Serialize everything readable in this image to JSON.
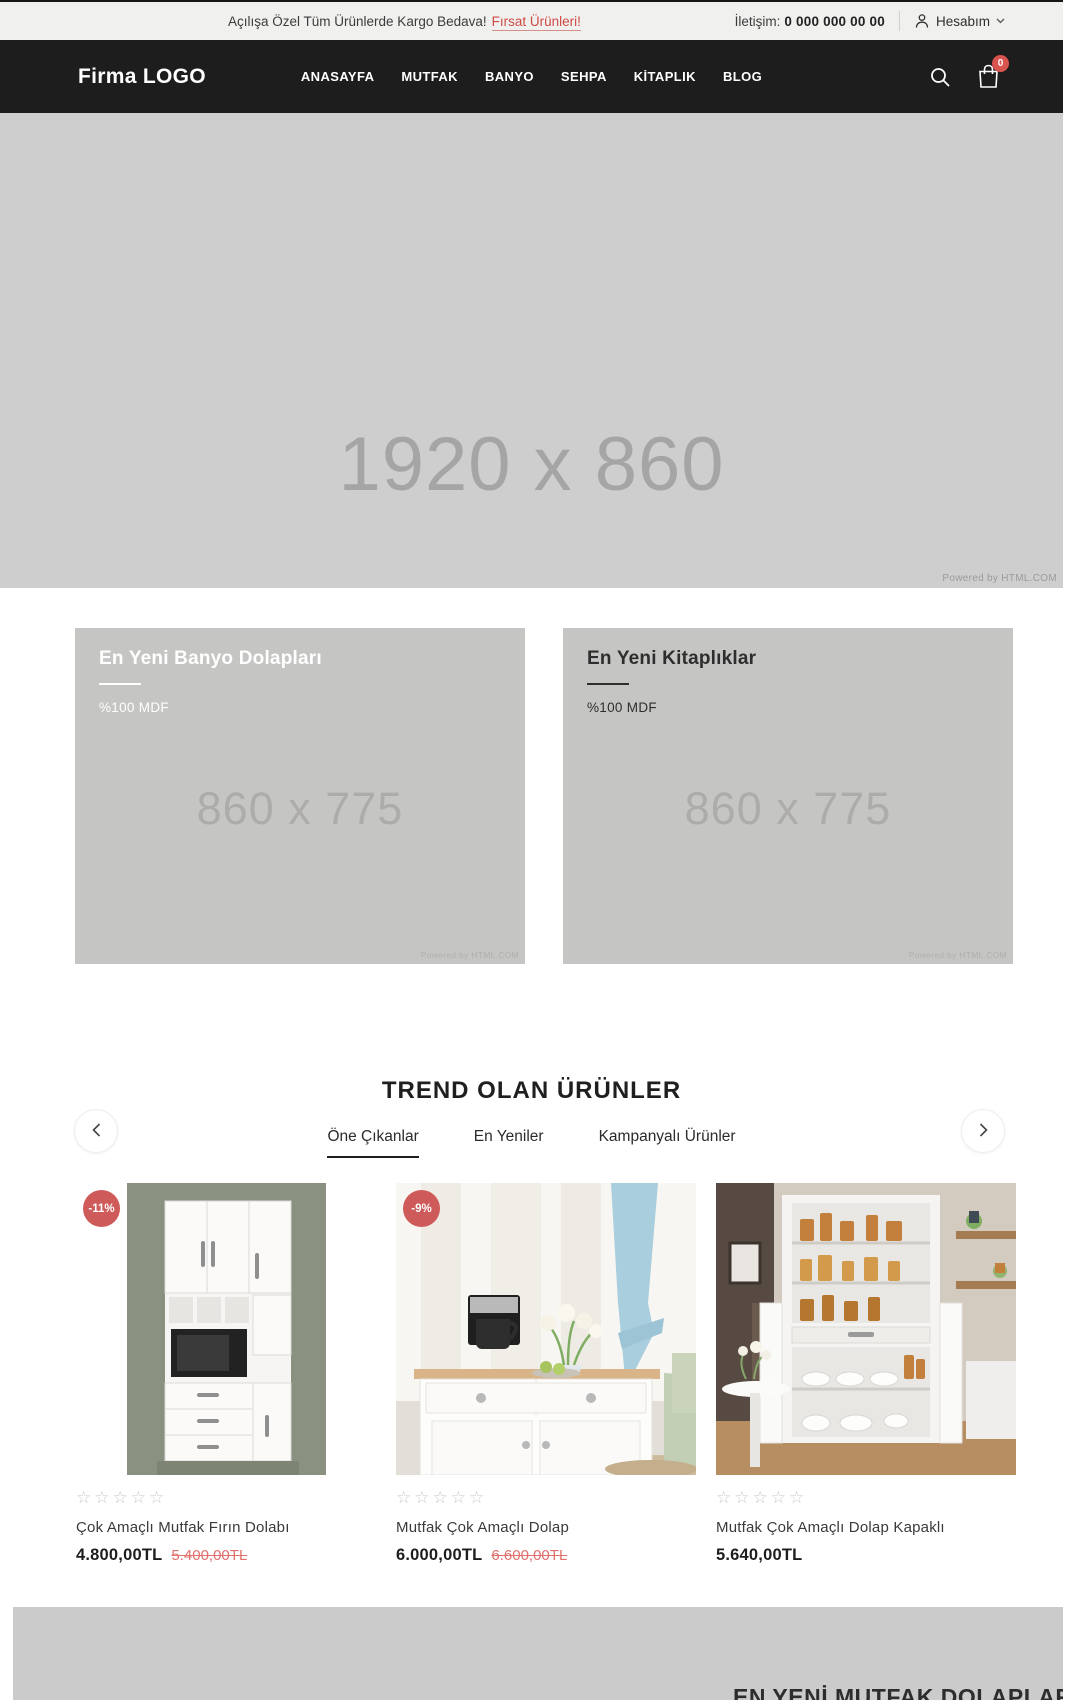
{
  "topbar": {
    "promo_text": "Açılışa Özel Tüm Ürünlerde Kargo Bedava!",
    "promo_link": "Fırsat Ürünleri!",
    "contact_label": "İletişim:",
    "contact_phone": "0 000 000 00 00",
    "account_label": "Hesabım"
  },
  "header": {
    "logo": "Firma LOGO",
    "nav": [
      "ANASAYFA",
      "MUTFAK",
      "BANYO",
      "SEHPA",
      "KİTAPLIK",
      "BLOG"
    ],
    "cart_count": "0"
  },
  "hero": {
    "placeholder": "1920 x 860",
    "watermark": "Powered by HTML.COM"
  },
  "banners": [
    {
      "title": "En Yeni Banyo Dolapları",
      "subtitle": "%100 MDF",
      "placeholder": "860 x 775",
      "watermark": "Powered by HTML.COM"
    },
    {
      "title": "En Yeni Kitaplıklar",
      "subtitle": "%100 MDF",
      "placeholder": "860 x 775",
      "watermark": "Powered by HTML.COM"
    }
  ],
  "trending": {
    "title": "TREND OLAN ÜRÜNLER",
    "tabs": [
      "Öne Çıkanlar",
      "En Yeniler",
      "Kampanyalı Ürünler"
    ],
    "products": [
      {
        "badge": "-11%",
        "stars": "☆☆☆☆☆",
        "name": "Çok Amaçlı Mutfak Fırın Dolabı",
        "price": "4.800,00TL",
        "old_price": "5.400,00TL"
      },
      {
        "badge": "-9%",
        "stars": "☆☆☆☆☆",
        "name": "Mutfak Çok Amaçlı Dolap",
        "price": "6.000,00TL",
        "old_price": "6.600,00TL"
      },
      {
        "stars": "☆☆☆☆☆",
        "name": "Mutfak Çok Amaçlı Dolap Kapaklı",
        "price": "5.640,00TL"
      }
    ]
  },
  "bottom_section": {
    "title": "EN YENİ MUTFAK DOLAPLARI"
  },
  "colors": {
    "accent_red": "#d9534f",
    "badge_red": "#cf5a5a",
    "old_price_red": "#e0716c",
    "header_bg": "#1d1d1d",
    "topbar_bg": "#f0f0ef",
    "placeholder_gray": "#cecece",
    "banner_gray": "#c5c6c3"
  }
}
